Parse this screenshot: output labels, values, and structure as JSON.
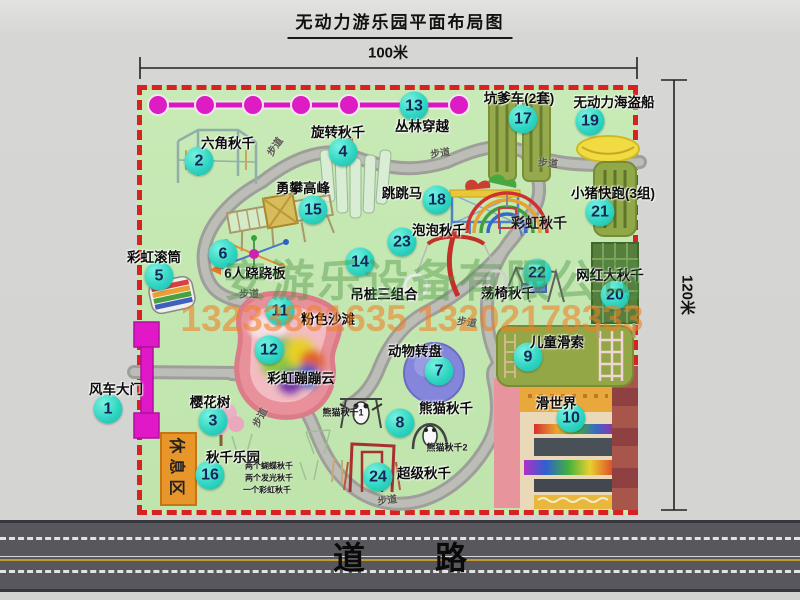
{
  "title": "无动力游乐园平面布局图",
  "dimensions": {
    "width": "100米",
    "height": "120米"
  },
  "watermark": {
    "company": "安游乐设备有限公司",
    "phone": "13233801635 13202178333"
  },
  "road": {
    "label": "道路"
  },
  "rest_area": {
    "label": "休息区"
  },
  "colors": {
    "border_red": "#d82222",
    "marker_teal": "#2fd6c2",
    "accent_magenta": "#e018c8",
    "park_green": "#c3e7b2",
    "road_gray": "#57575d"
  },
  "attractions": [
    {
      "num": 1,
      "label": "风车大门",
      "nx": 108,
      "ny": 409,
      "lx": 116,
      "ly": 388
    },
    {
      "num": 2,
      "label": "六角秋千",
      "nx": 199,
      "ny": 161,
      "lx": 228,
      "ly": 142
    },
    {
      "num": 3,
      "label": "樱花树",
      "nx": 213,
      "ny": 421,
      "lx": 210,
      "ly": 401
    },
    {
      "num": 4,
      "label": "旋转秋千",
      "nx": 343,
      "ny": 152,
      "lx": 338,
      "ly": 131
    },
    {
      "num": 5,
      "label": "彩虹滚筒",
      "nx": 159,
      "ny": 276,
      "lx": 154,
      "ly": 256
    },
    {
      "num": 6,
      "label": "6人跷跷板",
      "nx": 223,
      "ny": 254,
      "lx": 255,
      "ly": 272
    },
    {
      "num": 7,
      "label": "动物转盘",
      "nx": 439,
      "ny": 371,
      "lx": 415,
      "ly": 350
    },
    {
      "num": 8,
      "label": "熊猫秋千",
      "nx": 400,
      "ny": 423,
      "lx": 446,
      "ly": 407
    },
    {
      "num": 9,
      "label": "儿童滑索",
      "nx": 528,
      "ny": 357,
      "lx": 557,
      "ly": 341
    },
    {
      "num": 10,
      "label": "滑世界",
      "nx": 571,
      "ny": 418,
      "lx": 556,
      "ly": 402
    },
    {
      "num": 11,
      "label": "粉色沙滩",
      "nx": 280,
      "ny": 311,
      "lx": 328,
      "ly": 318
    },
    {
      "num": 12,
      "label": "彩虹蹦蹦云",
      "nx": 269,
      "ny": 350,
      "lx": 301,
      "ly": 377
    },
    {
      "num": 13,
      "label": "丛林穿越",
      "nx": 414,
      "ny": 106,
      "lx": 422,
      "ly": 125
    },
    {
      "num": 14,
      "label": "吊桩三组合",
      "nx": 360,
      "ny": 262,
      "lx": 384,
      "ly": 293
    },
    {
      "num": 15,
      "label": "勇攀高峰",
      "nx": 313,
      "ny": 210,
      "lx": 303,
      "ly": 187
    },
    {
      "num": 16,
      "label": "秋千乐园",
      "nx": 210,
      "ny": 475,
      "lx": 233,
      "ly": 456
    },
    {
      "num": 17,
      "label": "坑爹车(2套)",
      "nx": 523,
      "ny": 119,
      "lx": 519,
      "ly": 97
    },
    {
      "num": 18,
      "label": "跳跳马",
      "nx": 437,
      "ny": 200,
      "lx": 402,
      "ly": 192
    },
    {
      "num": 19,
      "label": "无动力海盗船",
      "nx": 590,
      "ny": 121,
      "lx": 614,
      "ly": 101
    },
    {
      "num": 20,
      "label": "网红大秋千",
      "nx": 615,
      "ny": 295,
      "lx": 610,
      "ly": 274
    },
    {
      "num": 21,
      "label": "小猪快跑(3组)",
      "nx": 600,
      "ny": 212,
      "lx": 613,
      "ly": 192
    },
    {
      "num": 22,
      "label": "荡椅秋千",
      "nx": 537,
      "ny": 273,
      "lx": 508,
      "ly": 292
    },
    {
      "num": 23,
      "label": "泡泡秋千",
      "nx": 402,
      "ny": 242,
      "lx": 439,
      "ly": 229
    },
    {
      "num": 24,
      "label": "超级秋千",
      "nx": 378,
      "ny": 477,
      "lx": 424,
      "ly": 472
    }
  ],
  "sub_labels": [
    {
      "text": "彩虹秋千",
      "x": 539,
      "y": 223,
      "fs": 14,
      "bold": true
    },
    {
      "text": "熊猫秋千1",
      "x": 343,
      "y": 412,
      "fs": 9,
      "bold": true
    },
    {
      "text": "熊猫秋千2",
      "x": 447,
      "y": 447,
      "fs": 9,
      "bold": true
    },
    {
      "text": "两个蝴蝶秋千",
      "x": 269,
      "y": 466,
      "fs": 8,
      "bold": true
    },
    {
      "text": "两个发光秋千",
      "x": 269,
      "y": 478,
      "fs": 8,
      "bold": true
    },
    {
      "text": "一个彩虹秋千",
      "x": 267,
      "y": 490,
      "fs": 8,
      "bold": true
    }
  ],
  "path_labels": [
    {
      "text": "步道",
      "x": 274,
      "y": 146,
      "rot": -55
    },
    {
      "text": "步道",
      "x": 440,
      "y": 152,
      "rot": -8
    },
    {
      "text": "步道",
      "x": 548,
      "y": 162,
      "rot": 5
    },
    {
      "text": "步道",
      "x": 249,
      "y": 293,
      "rot": 0
    },
    {
      "text": "步道",
      "x": 467,
      "y": 321,
      "rot": 8
    },
    {
      "text": "步道",
      "x": 259,
      "y": 417,
      "rot": -62
    },
    {
      "text": "步道",
      "x": 387,
      "y": 499,
      "rot": -8
    }
  ]
}
